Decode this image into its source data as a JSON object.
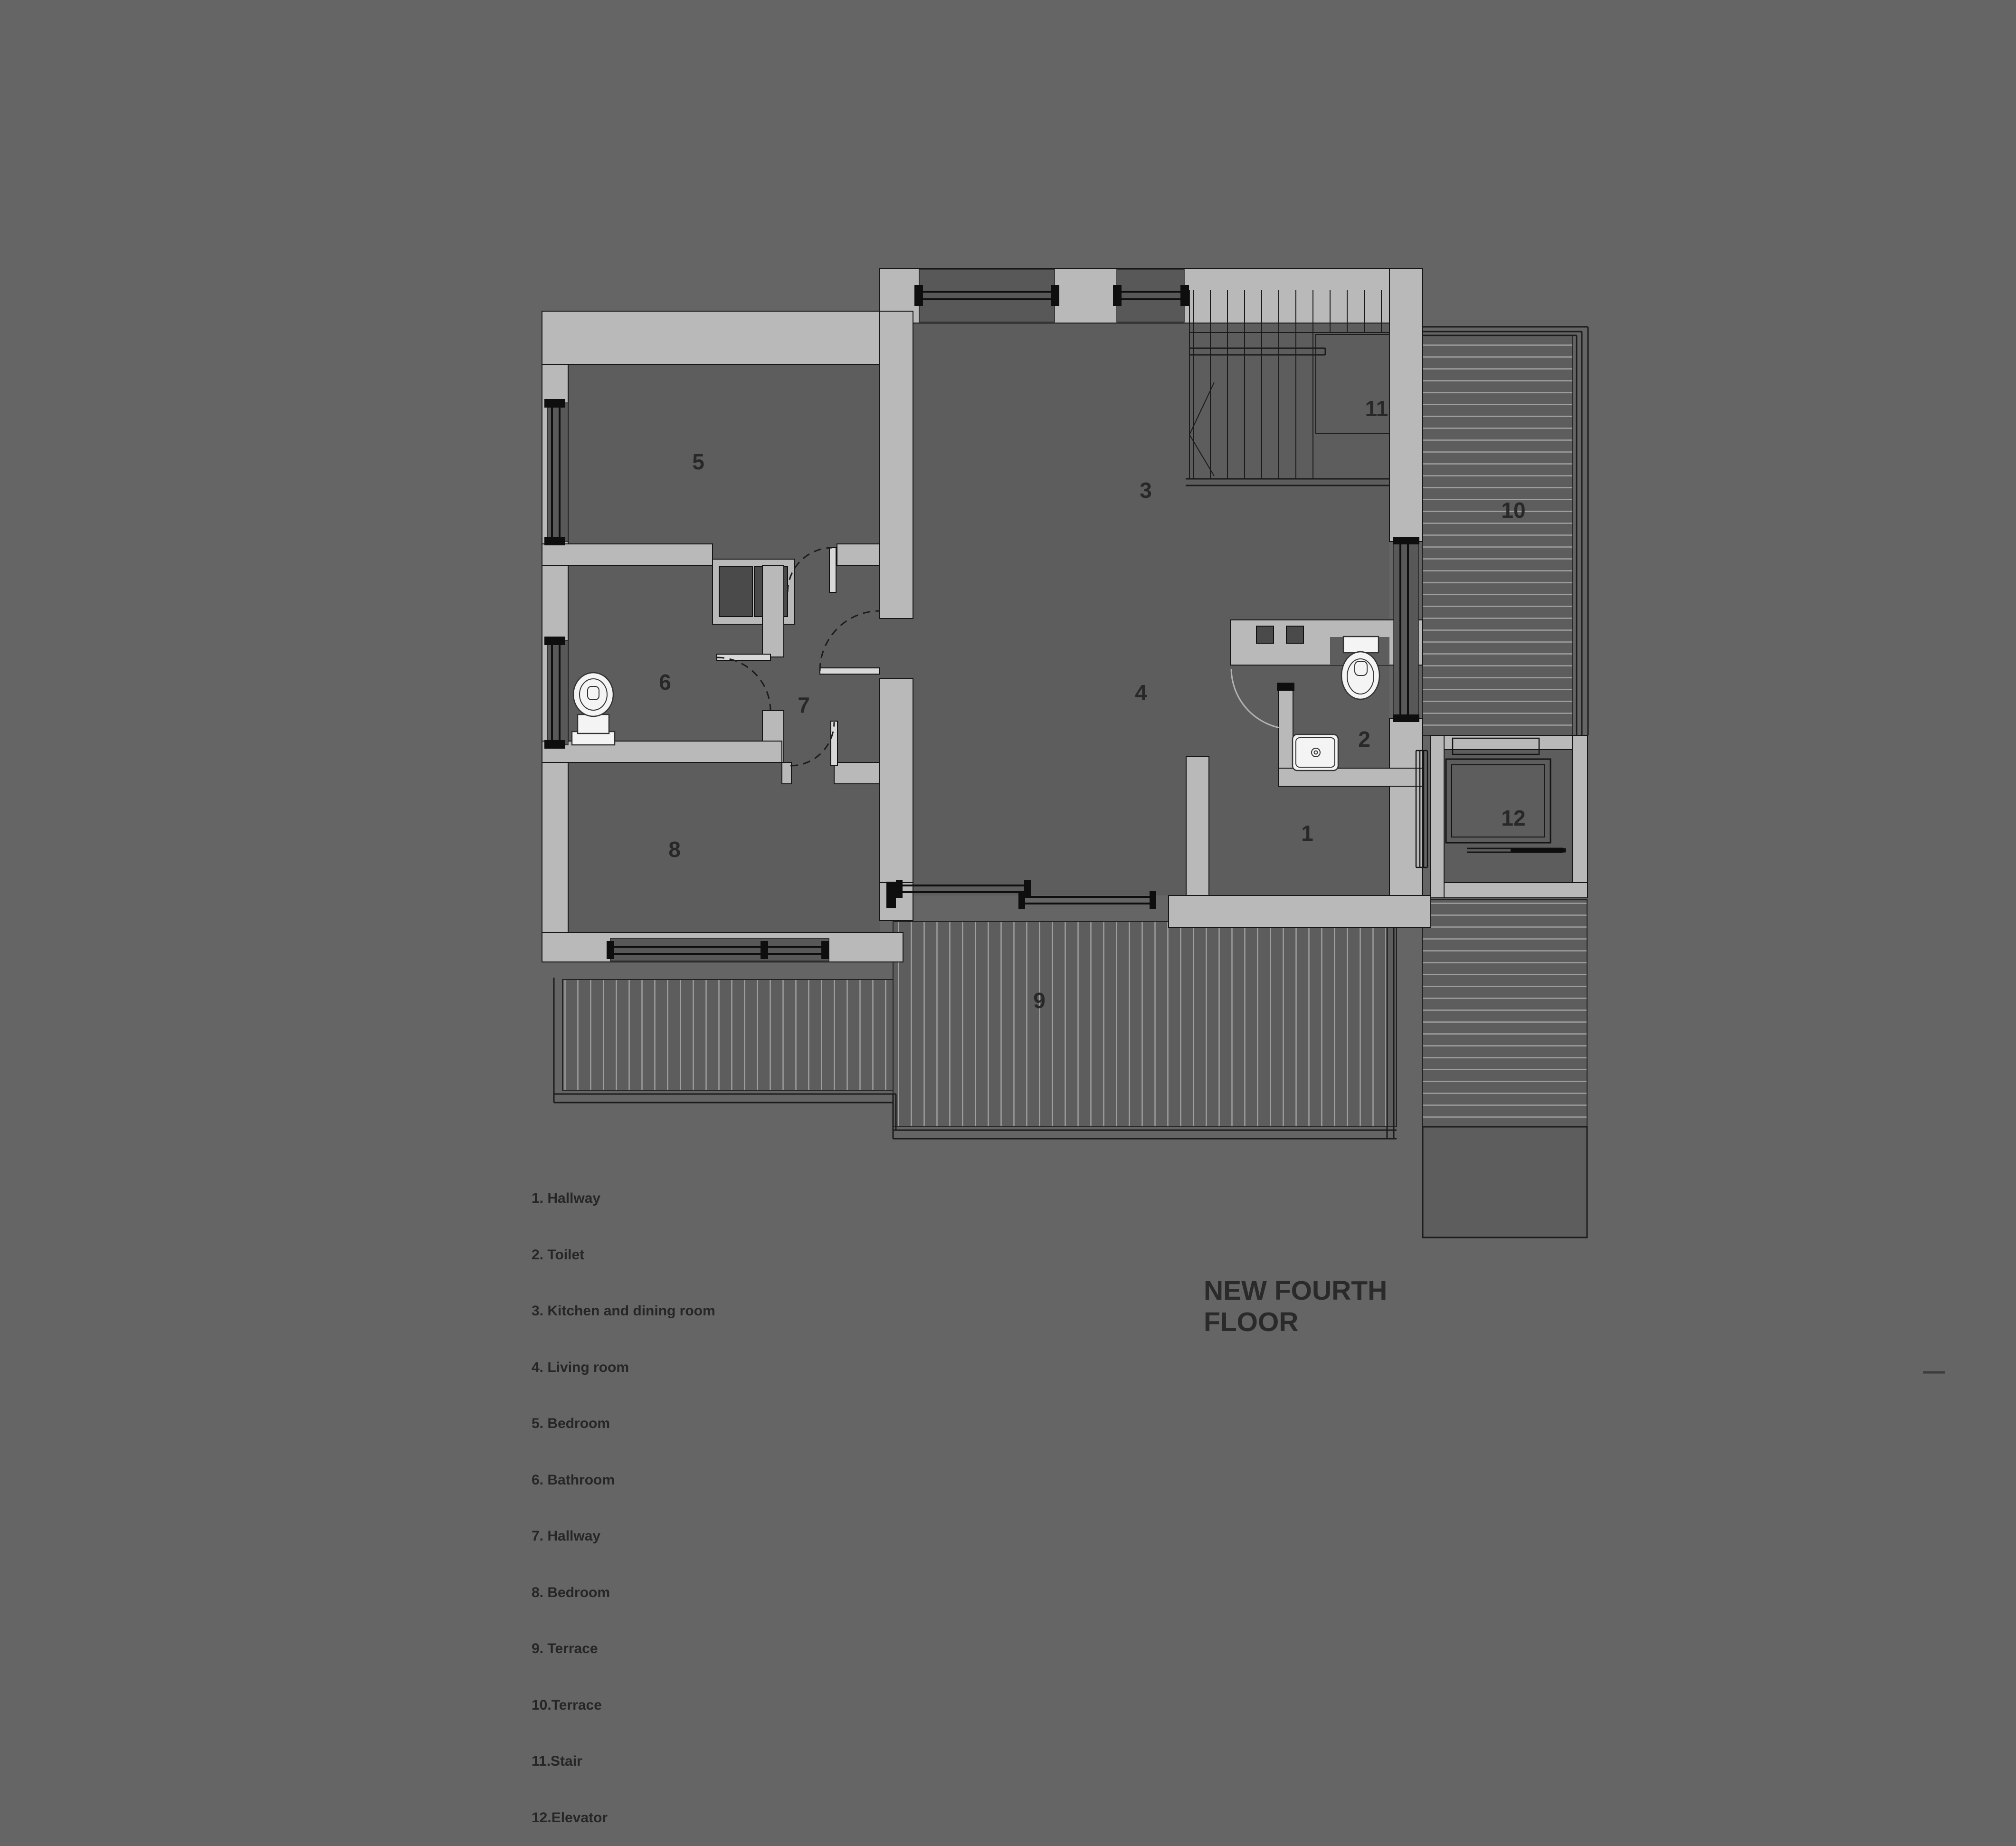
{
  "title": "NEW FOURTH FLOOR",
  "legend": {
    "items": [
      "1. Hallway",
      "2. Toilet",
      "3. Kitchen and dining room",
      "4. Living room",
      "5. Bedroom",
      "6. Bathroom",
      "7. Hallway",
      "8. Bedroom",
      "9. Terrace",
      "10.Terrace",
      "11.Stair",
      "12.Elevator"
    ]
  },
  "rooms": {
    "r1": {
      "num": "1",
      "name": "Hallway"
    },
    "r2": {
      "num": "2",
      "name": "Toilet"
    },
    "r3": {
      "num": "3",
      "name": "Kitchen and dining room"
    },
    "r4": {
      "num": "4",
      "name": "Living room"
    },
    "r5": {
      "num": "5",
      "name": "Bedroom"
    },
    "r6": {
      "num": "6",
      "name": "Bathroom"
    },
    "r7": {
      "num": "7",
      "name": "Hallway"
    },
    "r8": {
      "num": "8",
      "name": "Bedroom"
    },
    "r9": {
      "num": "9",
      "name": "Terrace"
    },
    "r10": {
      "num": "10",
      "name": "Terrace"
    },
    "r11": {
      "num": "11",
      "name": "Stair"
    },
    "r12": {
      "num": "12",
      "name": "Elevator"
    }
  },
  "colors": {
    "background": "#656565",
    "wall": "#b9b9b9",
    "floor": "#5d5d5d",
    "line": "#161616",
    "text": "#2a2a2a",
    "fixture": "#f4f4f4"
  }
}
